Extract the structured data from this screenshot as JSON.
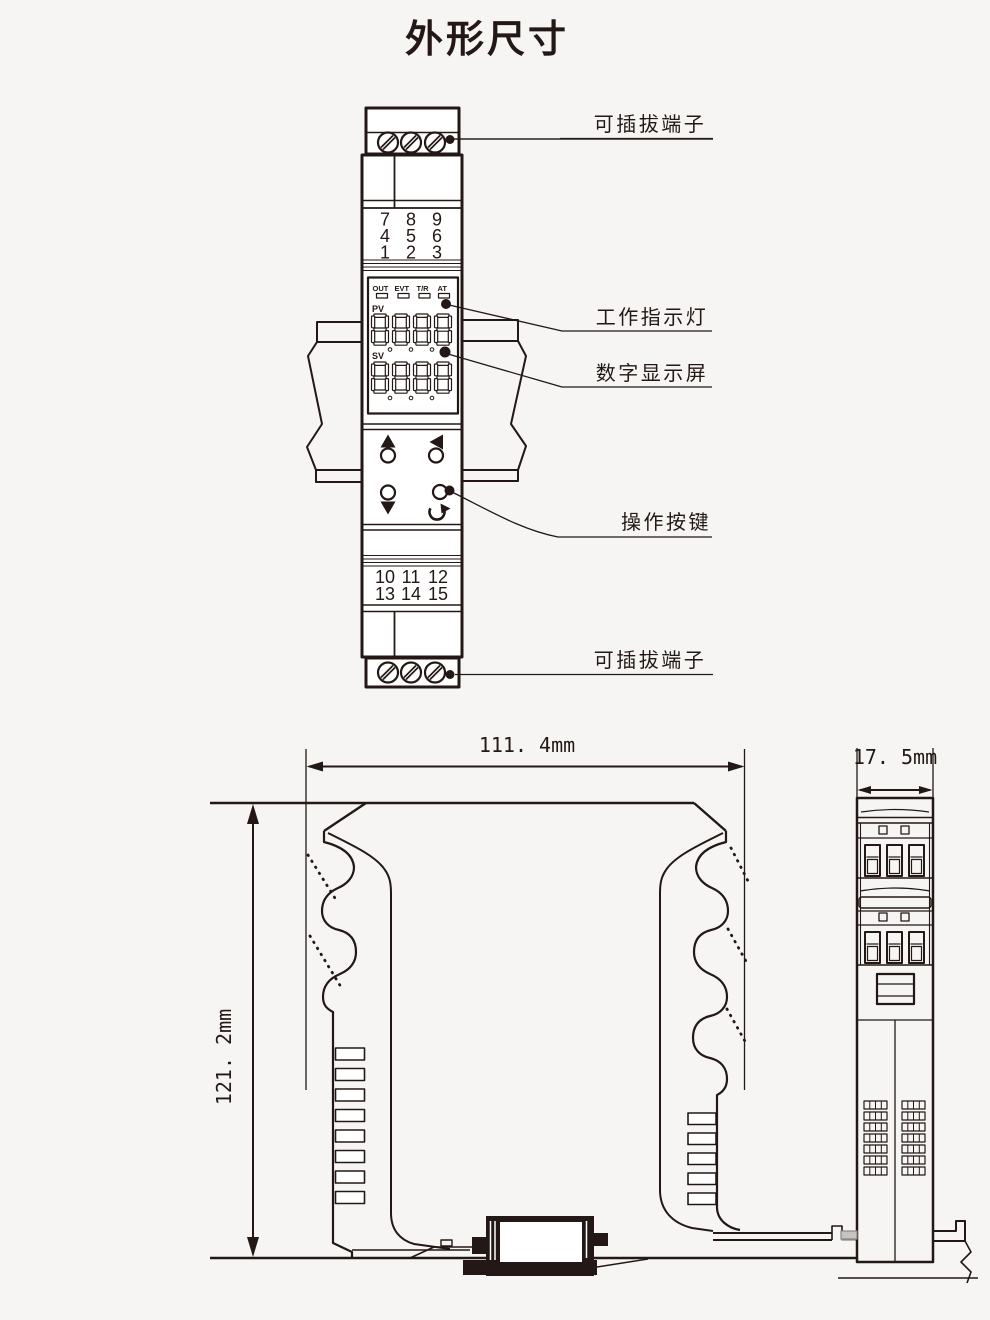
{
  "title": "外形尺寸",
  "callouts": {
    "terminal_top": "可插拔端子",
    "indicator_light": "工作指示灯",
    "digital_display": "数字显示屏",
    "operation_buttons": "操作按键",
    "terminal_bottom": "可插拔端子"
  },
  "front_view": {
    "indicators": [
      "OUT",
      "EVT",
      "T/R",
      "AT"
    ],
    "pv_label": "PV",
    "sv_label": "SV",
    "terminal_rows_top": [
      [
        "7",
        "8",
        "9"
      ],
      [
        "4",
        "5",
        "6"
      ],
      [
        "1",
        "2",
        "3"
      ]
    ],
    "terminal_rows_bottom": [
      [
        "10",
        "11",
        "12"
      ],
      [
        "13",
        "14",
        "15"
      ]
    ]
  },
  "dimensions": {
    "width": "111. 4mm",
    "height": "121. 2mm",
    "depth": "17. 5mm"
  },
  "colors": {
    "line": "#231815",
    "red_terminal": "#e60012",
    "background": "#f6f5f3"
  }
}
